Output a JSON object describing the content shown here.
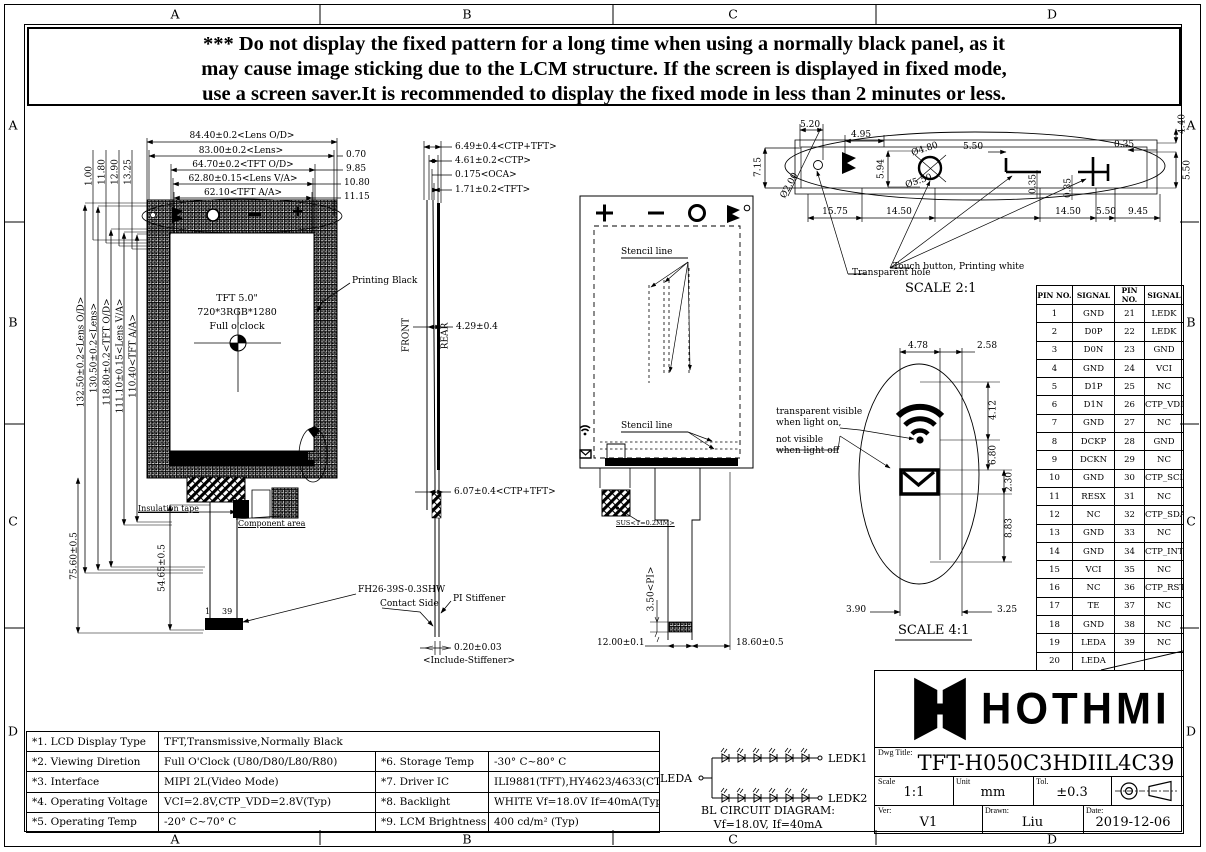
{
  "sheet": {
    "grid_letters": [
      "A",
      "B",
      "C",
      "D"
    ]
  },
  "warning": {
    "line1": "*** Do not display the fixed pattern for a long time when using a normally black panel, as it",
    "line2": "may cause image sticking due to the LCM structure. If the screen is displayed in fixed mode,",
    "line3": "use a screen saver.It is recommended to display the fixed mode in less than 2 minutes or less."
  },
  "front_view": {
    "top_dims": [
      "84.40±0.2<Lens O/D>",
      "83.00±0.2<Lens>",
      "64.70±0.2<TFT O/D>",
      "62.80±0.15<Lens V/A>",
      "62.10<TFT A/A>"
    ],
    "right_dims": [
      "0.70",
      "9.85",
      "10.80",
      "11.15"
    ],
    "left_small_dims": [
      "1.00",
      "11.80",
      "12.90",
      "13.25"
    ],
    "left_dims": [
      "132.50±0.2<Lens O/D>",
      "130.50±0.2<Lens>",
      "118.80±0.2<TFT O/D>",
      "111.10±0.15<Lens V/A>",
      "110.40<TFT A/A>"
    ],
    "height_dim_1": "75.60±0.5",
    "height_dim_2": "54.65±0.5",
    "center_text": [
      "TFT 5.0\"",
      "720*3RGB*1280",
      "Full o'clock"
    ],
    "labels": {
      "printing_black": "Printing Black",
      "insulation_tape": "Insulation tape",
      "component_area": "Component area",
      "connector": "FH26-39S-0.3SHW",
      "pin_first": "1",
      "pin_last": "39"
    }
  },
  "side_view": {
    "top_dims": [
      "6.49±0.4<CTP+TFT>",
      "4.61±0.2<CTP>",
      "0.175<OCA>",
      "1.71±0.2<TFT>"
    ],
    "mid_dim": "4.29±0.4",
    "front_label": "FRONT",
    "rear_label": "REAR",
    "lower_dim": "6.07±0.4<CTP+TFT>",
    "contact_side": "Contact Side",
    "pi_stiffener": "PI Stiffener",
    "bottom_dim": "0.20±0.03",
    "bottom_note": "<Include-Stiffener>"
  },
  "rear_view": {
    "stencil_label_1": "Stencil line",
    "stencil_label_2": "Stencil line",
    "sus_label": "SUS<T=0.2MM>",
    "pi_dim": "3.50<PI>",
    "bottom_left_dim": "12.00±0.1",
    "bottom_right_dim": "18.60±0.5"
  },
  "detail_2_1": {
    "scale_label": "SCALE 2:1",
    "d520": "5.20",
    "d495": "4.95",
    "d715": "7.15",
    "d440": "4.40",
    "dia200": "Ø2.00",
    "dia480": "Ø4.80",
    "dia550": "Ø5.50",
    "d594": "5.94",
    "d550_mid": "5.50",
    "d035_top": "0.35",
    "d550_right": "5.50",
    "bottom_dims": [
      "15.75",
      "14.50",
      "14.50",
      "5.50",
      "9.45"
    ],
    "d035_a": "0.35",
    "d035_b": "0.35",
    "touch_button_label": "Touch button, Printing white",
    "transparent_hole_label": "Transparent hole"
  },
  "detail_4_1": {
    "scale_label": "SCALE 4:1",
    "top_dim_1": "4.78",
    "top_dim_2": "2.58",
    "right_dims": [
      "4.12",
      "6.80",
      "2.30",
      "8.83"
    ],
    "bottom_dim_1": "3.90",
    "bottom_dim_2": "3.25",
    "note": [
      "transparent visible",
      "when light on,",
      "not visible",
      "when light off"
    ]
  },
  "pin_table": {
    "headers": [
      "PIN NO.",
      "SIGNAL",
      "PIN NO.",
      "SIGNAL"
    ],
    "rows": [
      [
        "1",
        "GND",
        "21",
        "LEDK"
      ],
      [
        "2",
        "D0P",
        "22",
        "LEDK"
      ],
      [
        "3",
        "D0N",
        "23",
        "GND"
      ],
      [
        "4",
        "GND",
        "24",
        "VCI"
      ],
      [
        "5",
        "D1P",
        "25",
        "NC"
      ],
      [
        "6",
        "D1N",
        "26",
        "CTP_VDD"
      ],
      [
        "7",
        "GND",
        "27",
        "NC"
      ],
      [
        "8",
        "DCKP",
        "28",
        "GND"
      ],
      [
        "9",
        "DCKN",
        "29",
        "NC"
      ],
      [
        "10",
        "GND",
        "30",
        "CTP_SCL"
      ],
      [
        "11",
        "RESX",
        "31",
        "NC"
      ],
      [
        "12",
        "NC",
        "32",
        "CTP_SDA"
      ],
      [
        "13",
        "GND",
        "33",
        "NC"
      ],
      [
        "14",
        "GND",
        "34",
        "CTP_INT"
      ],
      [
        "15",
        "VCI",
        "35",
        "NC"
      ],
      [
        "16",
        "NC",
        "36",
        "CTP_RST"
      ],
      [
        "17",
        "TE",
        "37",
        "NC"
      ],
      [
        "18",
        "GND",
        "38",
        "NC"
      ],
      [
        "19",
        "LEDA",
        "39",
        "NC"
      ],
      [
        "20",
        "LEDA",
        "",
        ""
      ]
    ]
  },
  "spec_table": {
    "rows": [
      [
        "*1. LCD Display Type",
        "TFT,Transmissive,Normally Black",
        "",
        ""
      ],
      [
        "*2. Viewing Diretion",
        "Full O'Clock (U80/D80/L80/R80)",
        "*6. Storage Temp",
        "-30° C~80° C"
      ],
      [
        "*3. Interface",
        "MIPI 2L(Video Mode)",
        "*7. Driver IC",
        "ILI9881(TFT),HY4623/4633(CTP)"
      ],
      [
        "*4. Operating Voltage",
        "VCI=2.8V,CTP_VDD=2.8V(Typ)",
        "*8. Backlight",
        "WHITE Vf=18.0V If=40mA(Typ)"
      ],
      [
        "*5. Operating Temp",
        "-20° C~70° C",
        "*9. LCM Brightness",
        "400 cd/m² (Typ)"
      ]
    ]
  },
  "bl_circuit": {
    "leda": "LEDA",
    "ledk1": "LEDK1",
    "ledk2": "LEDK2",
    "title": "BL CIRCUIT DIAGRAM:",
    "subtitle": "Vf=18.0V, If=40mA"
  },
  "title_block": {
    "brand": "HOTHMI",
    "dwg_title_label": "Dwg Title:",
    "dwg_title": "TFT-H050C3HDIIL4C39",
    "scale_label": "Scale",
    "scale": "1:1",
    "unit_label": "Unit",
    "unit": "mm",
    "tol_label": "Tol.",
    "tol": "±0.3",
    "ver_label": "Ver:",
    "ver": "V1",
    "drawn_label": "Drawn:",
    "drawn": "Liu",
    "date_label": "Date:",
    "date": "2019-12-06"
  }
}
